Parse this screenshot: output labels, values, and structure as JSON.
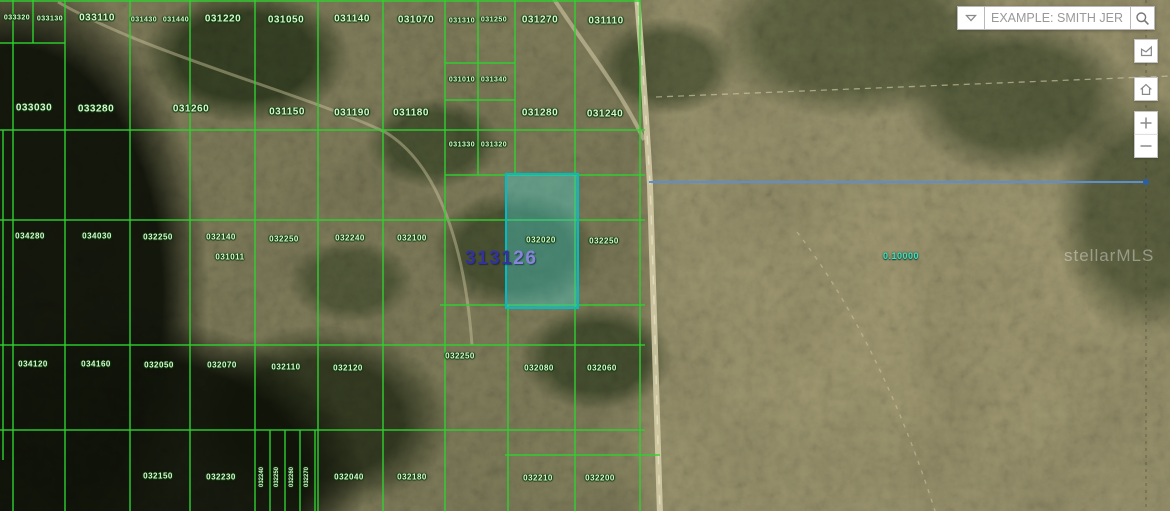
{
  "search_bar": {
    "placeholder": "EXAMPLE: SMITH JER...",
    "dropdown_icon": "chevron-down-icon",
    "search_icon": "magnifier-icon"
  },
  "map_controls": [
    {
      "name": "measure-area",
      "icon": "polygon-icon"
    },
    {
      "name": "home",
      "icon": "home-icon"
    },
    {
      "name": "zoom-in",
      "icon": "plus-icon"
    },
    {
      "name": "zoom-out",
      "icon": "minus-icon"
    }
  ],
  "map": {
    "watermark": "stellarMLS",
    "measurement_label": "0.10000",
    "selected_parcel": {
      "number_primary": "3131",
      "number_secondary": "26"
    },
    "colors": {
      "parcel_line": "#2fd32f",
      "parcel_label_text": "#daf5d2",
      "selection_outline": "#00bcc6",
      "selection_fill": "rgba(70,200,195,0.42)",
      "big_number_dark": "#32329b",
      "big_number_light": "#8585da",
      "measure_line_blue": "#5b8fd0",
      "measure_text_teal": "#49e0bd"
    },
    "parcel_labels": [
      {
        "text": "033320",
        "x": 17,
        "y": 18,
        "size": "s"
      },
      {
        "text": "033130",
        "x": 50,
        "y": 19,
        "size": "s"
      },
      {
        "text": "033110",
        "x": 97,
        "y": 18,
        "size": "l"
      },
      {
        "text": "031430",
        "x": 144,
        "y": 20,
        "size": "s"
      },
      {
        "text": "031440",
        "x": 176,
        "y": 20,
        "size": "s"
      },
      {
        "text": "031220",
        "x": 223,
        "y": 19,
        "size": "l"
      },
      {
        "text": "031050",
        "x": 286,
        "y": 20,
        "size": "l"
      },
      {
        "text": "031140",
        "x": 352,
        "y": 19,
        "size": "l"
      },
      {
        "text": "031070",
        "x": 416,
        "y": 20,
        "size": "l"
      },
      {
        "text": "031310",
        "x": 462,
        "y": 21,
        "size": "s"
      },
      {
        "text": "031250",
        "x": 494,
        "y": 20,
        "size": "s"
      },
      {
        "text": "031270",
        "x": 540,
        "y": 20,
        "size": "l"
      },
      {
        "text": "031110",
        "x": 606,
        "y": 21,
        "size": "l"
      },
      {
        "text": "033030",
        "x": 34,
        "y": 108,
        "size": "l"
      },
      {
        "text": "033280",
        "x": 96,
        "y": 109,
        "size": "l"
      },
      {
        "text": "031260",
        "x": 191,
        "y": 109,
        "size": "l"
      },
      {
        "text": "031150",
        "x": 287,
        "y": 112,
        "size": "l"
      },
      {
        "text": "031190",
        "x": 352,
        "y": 113,
        "size": "l"
      },
      {
        "text": "031180",
        "x": 411,
        "y": 113,
        "size": "l"
      },
      {
        "text": "031280",
        "x": 540,
        "y": 113,
        "size": "l"
      },
      {
        "text": "031240",
        "x": 605,
        "y": 114,
        "size": "l"
      },
      {
        "text": "031010",
        "x": 462,
        "y": 80,
        "size": "s"
      },
      {
        "text": "031340",
        "x": 494,
        "y": 80,
        "size": "s"
      },
      {
        "text": "031330",
        "x": 462,
        "y": 145,
        "size": "s"
      },
      {
        "text": "031320",
        "x": 494,
        "y": 145,
        "size": "s"
      },
      {
        "text": "034280",
        "x": 30,
        "y": 236,
        "size": "m"
      },
      {
        "text": "034030",
        "x": 97,
        "y": 236,
        "size": "m"
      },
      {
        "text": "032250",
        "x": 158,
        "y": 237,
        "size": "m"
      },
      {
        "text": "032140",
        "x": 221,
        "y": 237,
        "size": "m"
      },
      {
        "text": "031011",
        "x": 230,
        "y": 257,
        "size": "m"
      },
      {
        "text": "032250",
        "x": 284,
        "y": 239,
        "size": "m"
      },
      {
        "text": "032240",
        "x": 350,
        "y": 238,
        "size": "m"
      },
      {
        "text": "032100",
        "x": 412,
        "y": 238,
        "size": "m"
      },
      {
        "text": "032020",
        "x": 541,
        "y": 240,
        "size": "m"
      },
      {
        "text": "032250",
        "x": 604,
        "y": 241,
        "size": "m"
      },
      {
        "text": "032250",
        "x": 460,
        "y": 356,
        "size": "m"
      },
      {
        "text": "034120",
        "x": 33,
        "y": 364,
        "size": "m"
      },
      {
        "text": "034160",
        "x": 96,
        "y": 364,
        "size": "m"
      },
      {
        "text": "032050",
        "x": 159,
        "y": 365,
        "size": "m"
      },
      {
        "text": "032070",
        "x": 222,
        "y": 365,
        "size": "m"
      },
      {
        "text": "032110",
        "x": 286,
        "y": 367,
        "size": "m"
      },
      {
        "text": "032120",
        "x": 348,
        "y": 368,
        "size": "m"
      },
      {
        "text": "032080",
        "x": 539,
        "y": 368,
        "size": "m"
      },
      {
        "text": "032060",
        "x": 602,
        "y": 368,
        "size": "m"
      },
      {
        "text": "032150",
        "x": 158,
        "y": 476,
        "size": "m"
      },
      {
        "text": "032230",
        "x": 221,
        "y": 477,
        "size": "m"
      },
      {
        "text": "032240",
        "x": 262,
        "y": 477,
        "size": "xs",
        "rotate": -90
      },
      {
        "text": "032250",
        "x": 277,
        "y": 477,
        "size": "xs",
        "rotate": -90
      },
      {
        "text": "032260",
        "x": 292,
        "y": 477,
        "size": "xs",
        "rotate": -90
      },
      {
        "text": "032270",
        "x": 307,
        "y": 477,
        "size": "xs",
        "rotate": -90
      },
      {
        "text": "032040",
        "x": 349,
        "y": 477,
        "size": "m"
      },
      {
        "text": "032180",
        "x": 412,
        "y": 477,
        "size": "m"
      },
      {
        "text": "032210",
        "x": 538,
        "y": 478,
        "size": "m"
      },
      {
        "text": "032200",
        "x": 600,
        "y": 478,
        "size": "m"
      }
    ]
  }
}
